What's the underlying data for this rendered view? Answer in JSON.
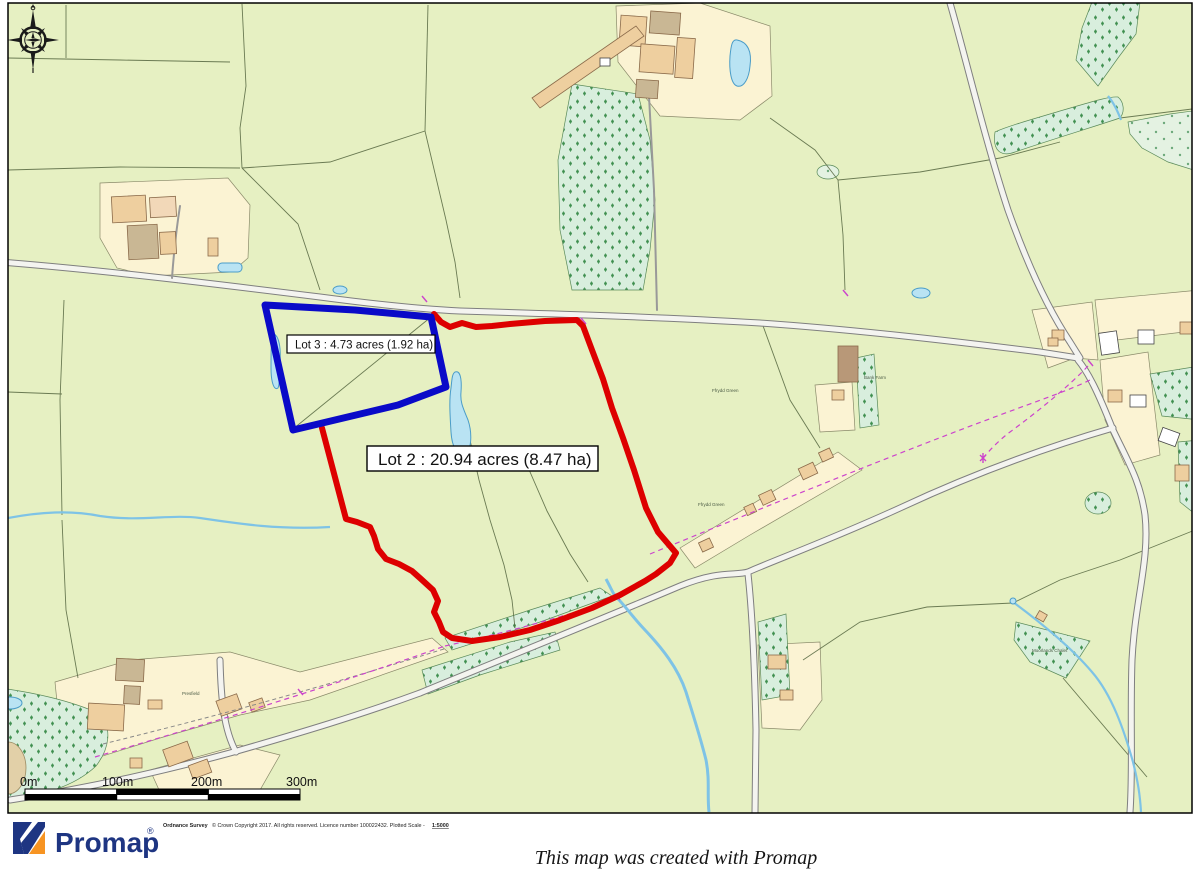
{
  "map": {
    "lot2": {
      "label": "Lot 2 : 20.94 acres (8.47 ha)",
      "color": "#dd0000"
    },
    "lot3": {
      "label": "Lot 3 : 4.73 acres (1.92 ha)",
      "color": "#0a0ac8"
    },
    "tiny_labels": {
      "presfield": "Presfield",
      "bank_farm": "Bank Farm",
      "ffrydd_green_upper": "Ffrydd Green",
      "ffrydd_green_lower": "Ffrydd Green",
      "moorlands": "Moorlands Chalet"
    },
    "scale_bar": {
      "labels": [
        "0m",
        "100m",
        "200m",
        "300m"
      ]
    },
    "colors": {
      "field": "#e6f0c2",
      "woodland": "#d8eedd",
      "village_cream": "#fbf3d3",
      "building_tan": "#eecf9f",
      "water": "#b9e3f3",
      "footpath_magenta": "#cc44cc",
      "road_casing": "#7f7f7f"
    }
  },
  "footer": {
    "copyright_bold": "Ordnance Survey",
    "copyright_text": "© Crown Copyright 2017. All rights reserved. Licence number 100022432. Plotted Scale -",
    "copyright_scale": "1:5000",
    "logo_text": "Promap",
    "logo_reg": "®",
    "tagline": "This map was created with Promap",
    "logo_navy": "#1e3582",
    "logo_orange": "#f79422"
  }
}
